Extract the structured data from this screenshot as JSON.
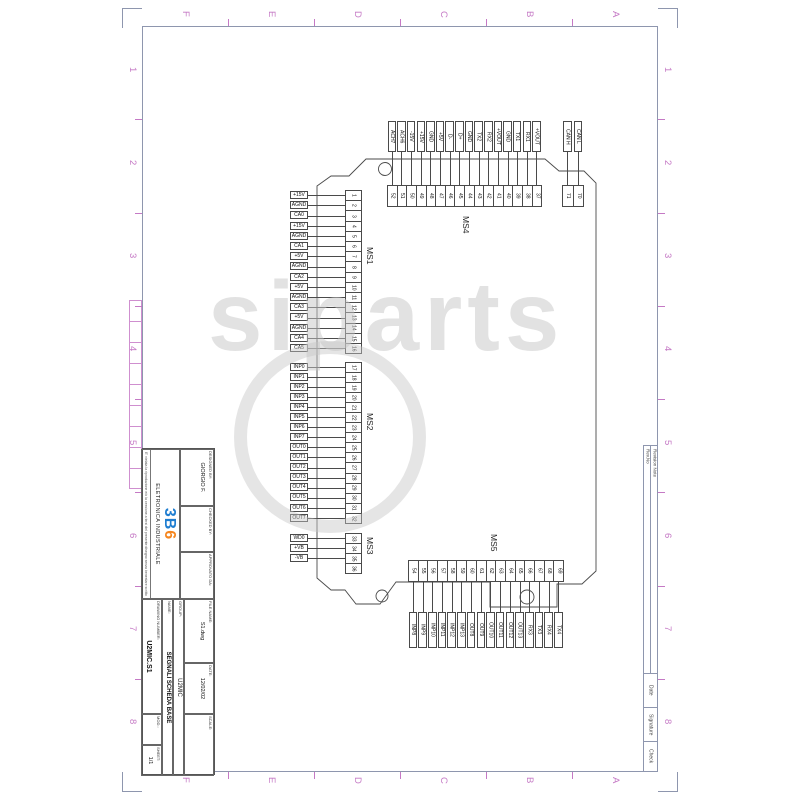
{
  "sheet": {
    "border_letters": [
      "F",
      "E",
      "D",
      "C",
      "B",
      "A"
    ],
    "border_numbers": [
      "1",
      "2",
      "3",
      "4",
      "5",
      "6",
      "7",
      "8"
    ],
    "revision_strip": {
      "rev_no": "Rev.No",
      "revision_note": "Revision Note",
      "date": "Date",
      "signature": "Signature",
      "check": "Check"
    }
  },
  "title_block": {
    "designed_by_label": "DESIGNED BY:",
    "designed_by_value": "GIORGIO F.",
    "checked_by_label": "CHECKED BY:",
    "approved_by_label": "APPROVATO DA:",
    "file_name_label": "FILE NAME:",
    "file_name_value": "S1.dwg",
    "date_label": "DATE:",
    "date_value": "12/02/02",
    "scale_label": "SCALE:",
    "group_label": "GROUP:",
    "group_value": "U2MIC",
    "name_label": "NAME:",
    "name_value": "SEGNALI SCHEDA BASE",
    "drawing_number_label": "DRAWING NUMBER:",
    "drawing_number_value": "U2MIC.S1",
    "mod_label": "MOD.:",
    "sheet_label": "SHEET:",
    "sheet_value": "1/1",
    "logo_3": "3",
    "logo_b": "B",
    "logo_6": "6",
    "company": "ELETRONICA INDUSTRIALE",
    "fine_print": "E' vietata la riproduzione e/o la cessione a terzi del presente disegno senza benestare scritto"
  },
  "connectors": {
    "ms1": {
      "name": "MS1",
      "pins": [
        {
          "n": "1",
          "label": "+15V"
        },
        {
          "n": "2",
          "label": "AGND"
        },
        {
          "n": "3",
          "label": "CA0"
        },
        {
          "n": "4",
          "label": "+15V"
        },
        {
          "n": "5",
          "label": "AGND"
        },
        {
          "n": "6",
          "label": "CA1"
        },
        {
          "n": "7",
          "label": "+5V"
        },
        {
          "n": "8",
          "label": "AGND"
        },
        {
          "n": "9",
          "label": "CA2"
        },
        {
          "n": "10",
          "label": "+5V"
        },
        {
          "n": "11",
          "label": "AGND"
        },
        {
          "n": "12",
          "label": "CA3"
        },
        {
          "n": "13",
          "label": "+5V"
        },
        {
          "n": "14",
          "label": "AGND"
        },
        {
          "n": "15",
          "label": "CA4"
        },
        {
          "n": "16",
          "label": "CA5"
        }
      ]
    },
    "ms2": {
      "name": "MS2",
      "pins": [
        {
          "n": "17",
          "label": "INP0"
        },
        {
          "n": "18",
          "label": "INP1"
        },
        {
          "n": "19",
          "label": "INP2"
        },
        {
          "n": "20",
          "label": "INP3"
        },
        {
          "n": "21",
          "label": "INP4"
        },
        {
          "n": "22",
          "label": "INP5"
        },
        {
          "n": "23",
          "label": "INP6"
        },
        {
          "n": "24",
          "label": "INP7"
        },
        {
          "n": "25",
          "label": "OUT0"
        },
        {
          "n": "26",
          "label": "OUT1"
        },
        {
          "n": "27",
          "label": "OUT2"
        },
        {
          "n": "28",
          "label": "OUT3"
        },
        {
          "n": "29",
          "label": "OUT4"
        },
        {
          "n": "30",
          "label": "OUT5"
        },
        {
          "n": "31",
          "label": "OUT6"
        },
        {
          "n": "32",
          "label": "OUT7"
        }
      ]
    },
    "ms3": {
      "name": "MS3",
      "pins": [
        {
          "n": "33",
          "label": "WD0"
        },
        {
          "n": "34",
          "label": "+VB"
        },
        {
          "n": "35",
          "label": "-VB"
        },
        {
          "n": "36",
          "label": ""
        }
      ]
    },
    "ms4": {
      "name": "MS4",
      "pins": [
        {
          "n": "52",
          "label": "ACH7"
        },
        {
          "n": "51",
          "label": "ACH6"
        },
        {
          "n": "50",
          "label": "-15V"
        },
        {
          "n": "49",
          "label": "+15V"
        },
        {
          "n": "48",
          "label": "GND"
        },
        {
          "n": "47",
          "label": "+5V"
        },
        {
          "n": "46",
          "label": "D-"
        },
        {
          "n": "45",
          "label": "D+"
        },
        {
          "n": "44",
          "label": "GND"
        },
        {
          "n": "43",
          "label": "TX2"
        },
        {
          "n": "42",
          "label": "RX2"
        },
        {
          "n": "41",
          "label": "+VOUT"
        },
        {
          "n": "40",
          "label": "GND"
        },
        {
          "n": "39",
          "label": "TX1"
        },
        {
          "n": "38",
          "label": "RX1"
        },
        {
          "n": "37",
          "label": "+VOUT"
        }
      ]
    },
    "can": {
      "name": "",
      "pins": [
        {
          "n": "71",
          "label": "CAN H"
        },
        {
          "n": "70",
          "label": "CAN L"
        }
      ]
    },
    "ms5": {
      "name": "MS5",
      "pins": [
        {
          "n": "54",
          "label": "INP8"
        },
        {
          "n": "55",
          "label": "INP9"
        },
        {
          "n": "56",
          "label": "INP10"
        },
        {
          "n": "57",
          "label": "INP11"
        },
        {
          "n": "58",
          "label": "INP12"
        },
        {
          "n": "59",
          "label": "INP13"
        },
        {
          "n": "60",
          "label": "OUT8"
        },
        {
          "n": "61",
          "label": "OUT9"
        },
        {
          "n": "62",
          "label": "OUT10"
        },
        {
          "n": "63",
          "label": "OUT11"
        },
        {
          "n": "64",
          "label": "OUT12"
        },
        {
          "n": "65",
          "label": "OUT13"
        },
        {
          "n": "66",
          "label": "RX3"
        },
        {
          "n": "67",
          "label": "TX3"
        },
        {
          "n": "68",
          "label": "RX4"
        },
        {
          "n": "69",
          "label": "TX4"
        }
      ]
    }
  },
  "watermark": {
    "text": "siparts"
  },
  "colors": {
    "frame": "#8e96ae",
    "accent_magenta": "#c579c5",
    "drawing_line": "#4a4a4a",
    "logo_blue": "#1e7dd0",
    "logo_orange": "#f5861e",
    "watermark_gray": "#c6c6c6"
  }
}
